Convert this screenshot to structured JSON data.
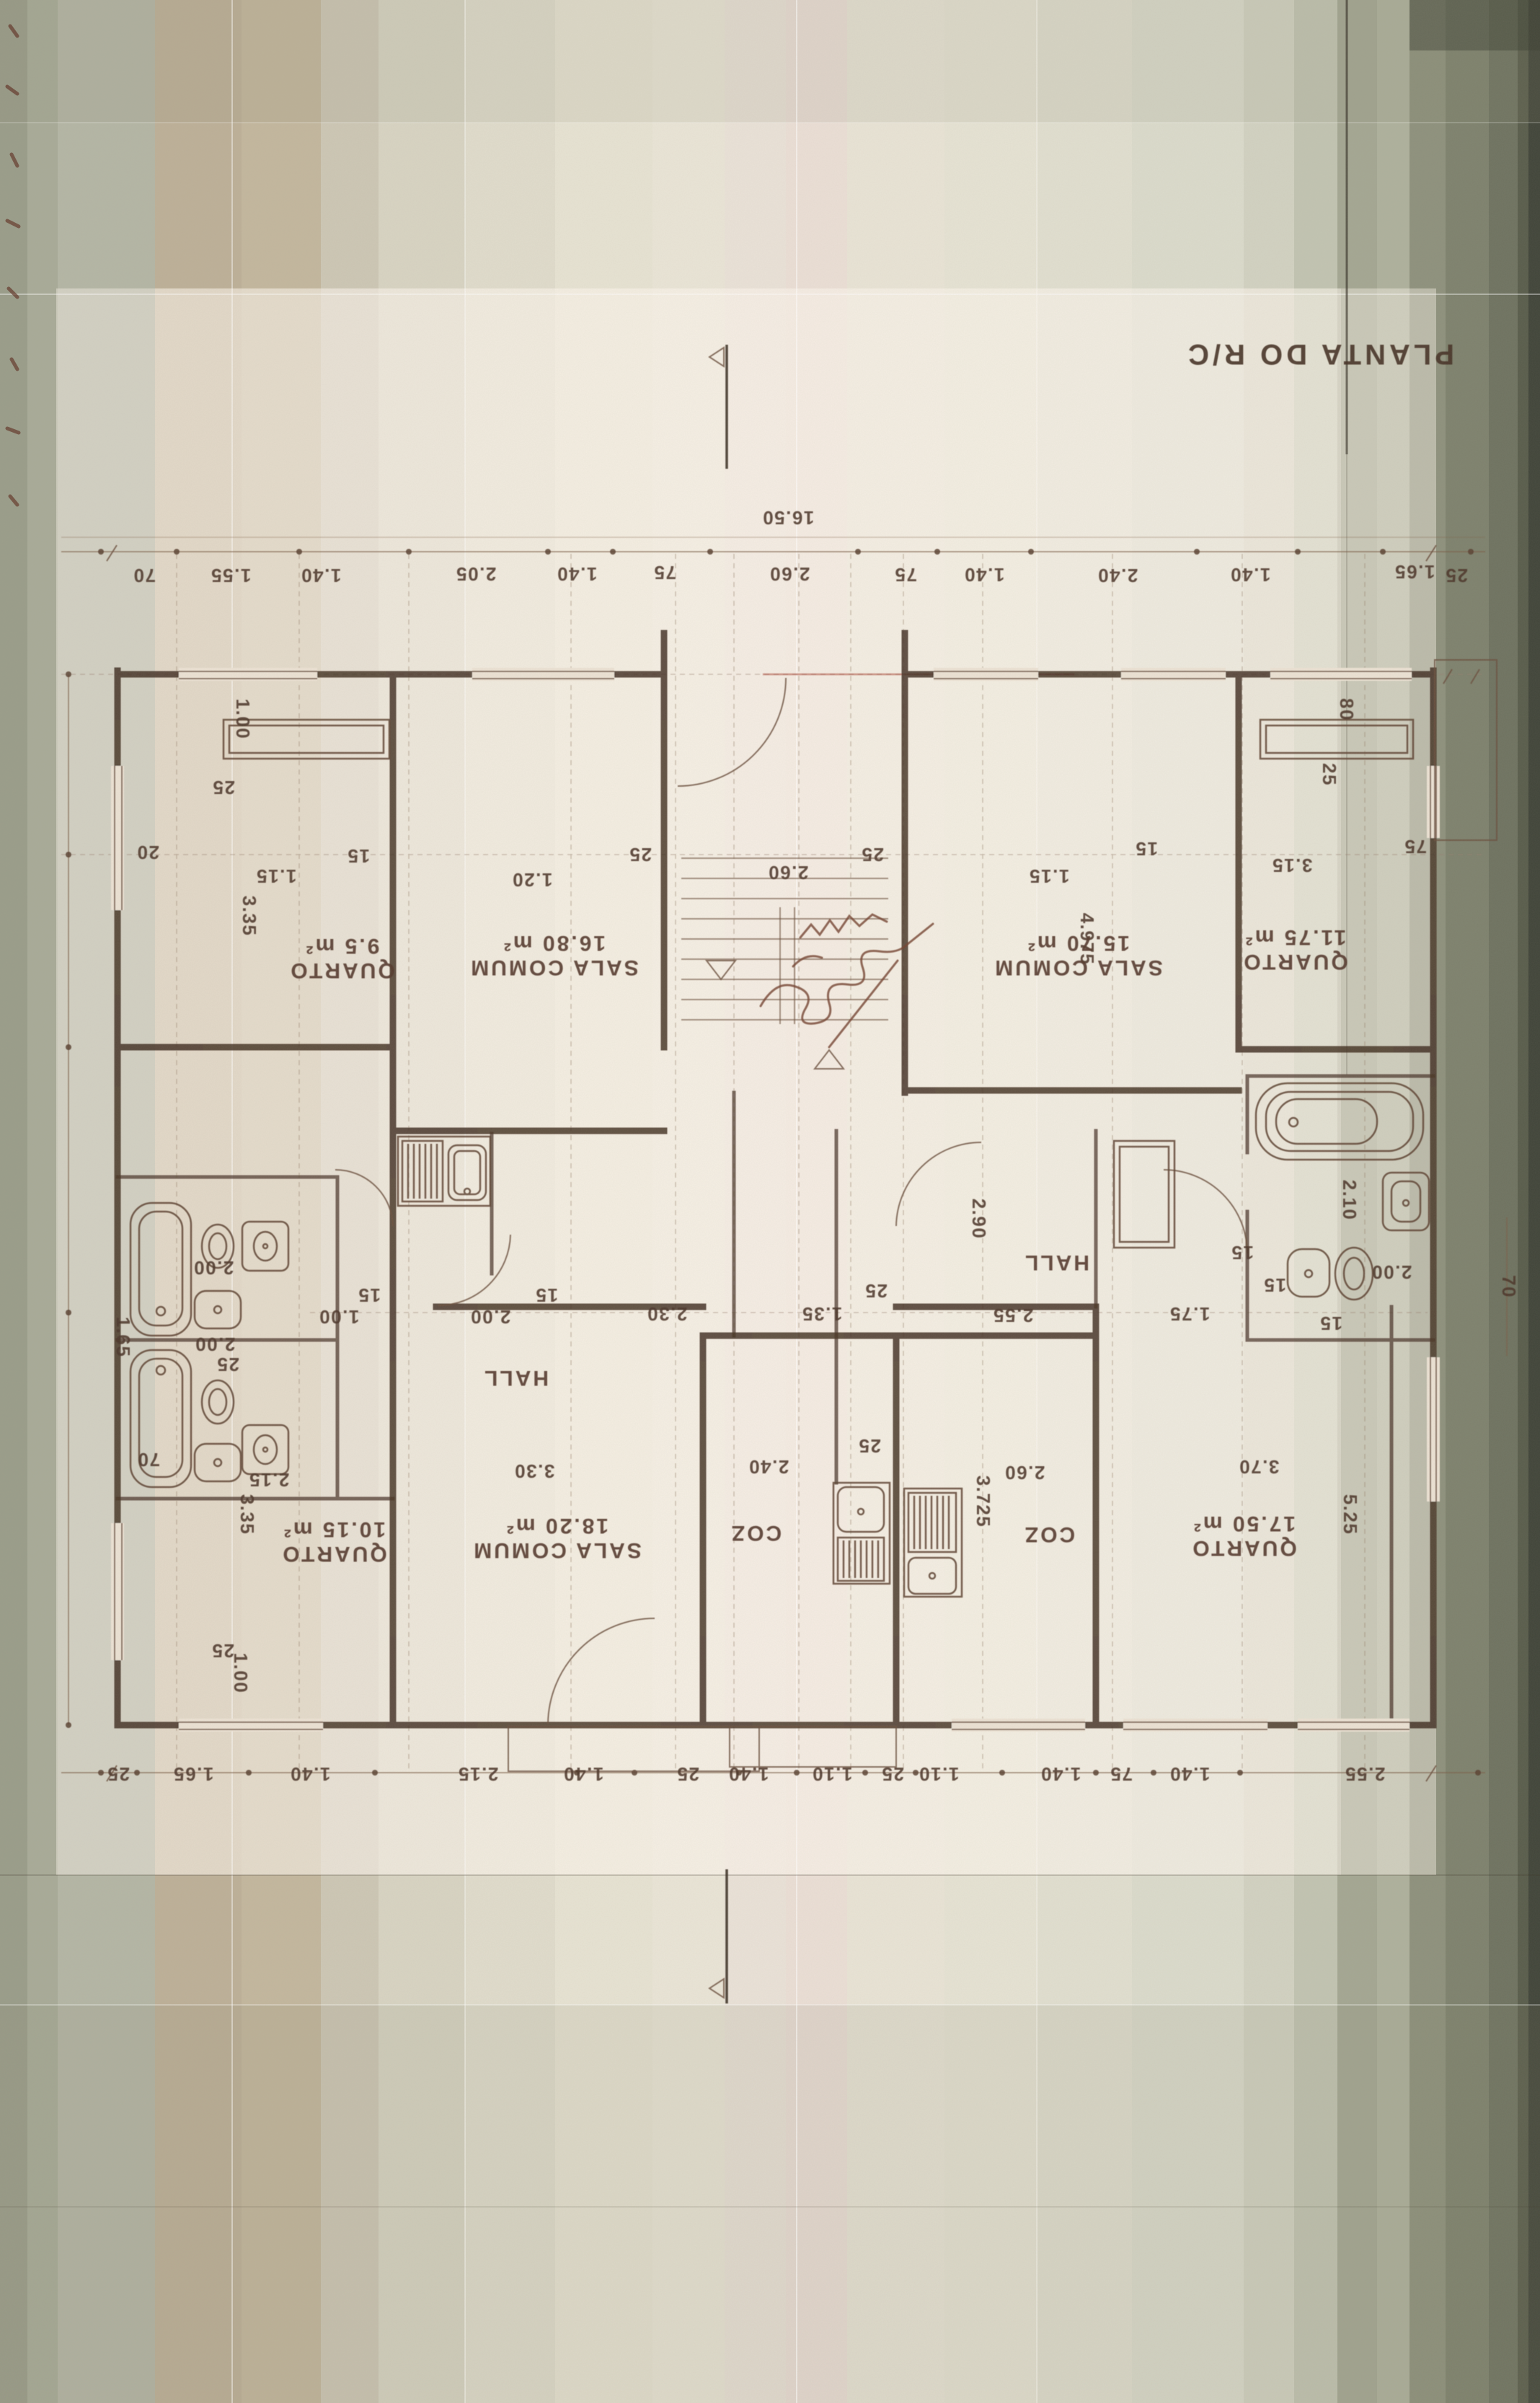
{
  "title": "PLANTA DO R/C",
  "dims": {
    "overall_top": "16.50",
    "top": [
      "70",
      "1.55",
      "1.40",
      "2.05",
      "1.40",
      "75",
      "2.60",
      "75",
      "1.40",
      "2.40",
      "1.40",
      "1.65",
      "25"
    ],
    "bottom": [
      "25",
      "1.65",
      "1.40",
      "2.15",
      "1.40",
      "25",
      "1.40",
      "1.10",
      "25",
      "1.10",
      "1.40",
      "75",
      "1.40",
      "2.55"
    ],
    "middle": [
      "1.00",
      "15",
      "2.00",
      "15",
      "2.30",
      "1.35",
      "25",
      "2.55",
      "1.75",
      "15",
      "2.00"
    ],
    "interior": [
      "2.60",
      "25",
      "25",
      "1.20",
      "15",
      "1.15",
      "20",
      "25",
      "1.00",
      "3.35",
      "1.15",
      "15",
      "3.15",
      "75",
      "80",
      "25",
      "4.975",
      "2.90",
      "2.10",
      "2.00",
      "1.65",
      "2.00",
      "25",
      "70",
      "2.15",
      "3.35",
      "1.00",
      "25",
      "15",
      "15",
      "70",
      "5.25",
      "3.725",
      "25",
      "2.40",
      "2.60",
      "3.30",
      "3.70"
    ]
  },
  "rooms": [
    {
      "name": "QUARTO",
      "area": "9.5 m²"
    },
    {
      "name": "SALA COMUM",
      "area": "16.80 m²"
    },
    {
      "name": "SALA COMUM",
      "area": "15.70 m²"
    },
    {
      "name": "QUARTO",
      "area": "11.75 m²"
    },
    {
      "name": "QUARTO",
      "area": "10.15 m²"
    },
    {
      "name": "SALA COMUM",
      "area": "18.20 m²"
    },
    {
      "name": "COZ"
    },
    {
      "name": "COZ"
    },
    {
      "name": "HALL"
    },
    {
      "name": "HALL"
    },
    {
      "name": "QUARTO",
      "area": "17.50 m²"
    }
  ]
}
